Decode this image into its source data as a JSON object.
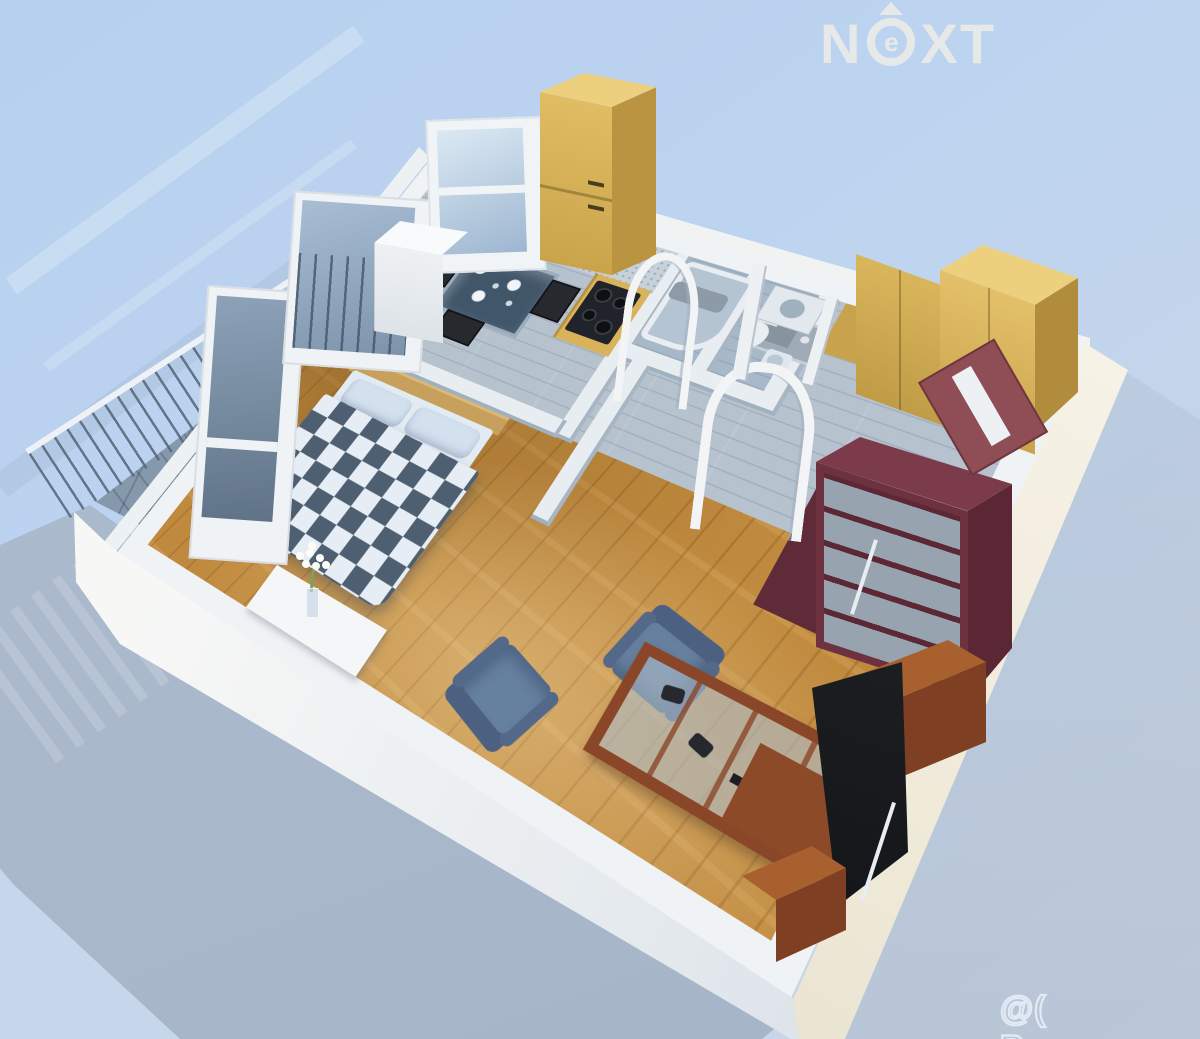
{
  "watermarks": {
    "logo": {
      "n": "N",
      "e": "e",
      "x": "X",
      "t": "T",
      "display": "NEXT"
    },
    "site": "@( Bazos.cz"
  },
  "palette": {
    "background_blue": "#b9d2ef",
    "shadow_blue": "#a9b8cb",
    "wall_white": "#f3f5f3",
    "wall_cream": "#efe9d8",
    "interior_wall_grey": "#a8b6c3",
    "floor_wood": "#c08a3e",
    "floor_grey_laminate": "#b6c2ce",
    "balcony_tile": "#8699ac",
    "duvet_dark": "#4e5f71",
    "duvet_light": "#e6edf4",
    "cabinet_yellow": "#d9b35b",
    "wardrobe_maroon": "#6e3140",
    "shoji_panel_grey": "#97a3af",
    "armchair_blue": "#66809f",
    "cherry_wood": "#8a4628",
    "cooktop_black": "#20242a",
    "logo_grey": "#e9e6e1",
    "watermark_outline": "#e9f1fa"
  },
  "scene": {
    "view": "isometric 3D floor plan render of a studio apartment",
    "rooms": [
      {
        "name": "balcony",
        "floor": "grey tiles",
        "items": [
          "metal railing",
          "glazed balcony door",
          "glazed wall"
        ]
      },
      {
        "name": "kitchen-dining",
        "floor": "grey laminate",
        "items": [
          "window",
          "tall yellow cabinet",
          "white fridge",
          "speckled sink counter",
          "yellow counter with black cooktop",
          "glass dining table with plates",
          "black chairs"
        ]
      },
      {
        "name": "bathroom",
        "floor": "grey laminate",
        "items": [
          "corner bathtub",
          "grey towel",
          "open white door"
        ]
      },
      {
        "name": "wc",
        "floor": "grey laminate",
        "items": [
          "toilet",
          "washbasin",
          "washing machine",
          "open white door"
        ]
      },
      {
        "name": "hallway",
        "floor": "grey laminate",
        "items": [
          "yellow wardrobes",
          "open maroon entrance door with mirror",
          "cherry drawer chest"
        ]
      },
      {
        "name": "bedroom",
        "floor": "wooden parquet",
        "items": [
          "double bed",
          "blue-white checkered duvet",
          "two pillows",
          "wooden headboard",
          "white console table",
          "daisy flower vase"
        ]
      },
      {
        "name": "living-area",
        "floor": "wooden parquet",
        "items": [
          "two blue armchairs",
          "cherry coffee table with glass top",
          "game controllers",
          "remote control",
          "curved tv",
          "cherry tv cabinets",
          "maroon shoji wardrobe",
          "two arched doorways"
        ]
      }
    ]
  }
}
